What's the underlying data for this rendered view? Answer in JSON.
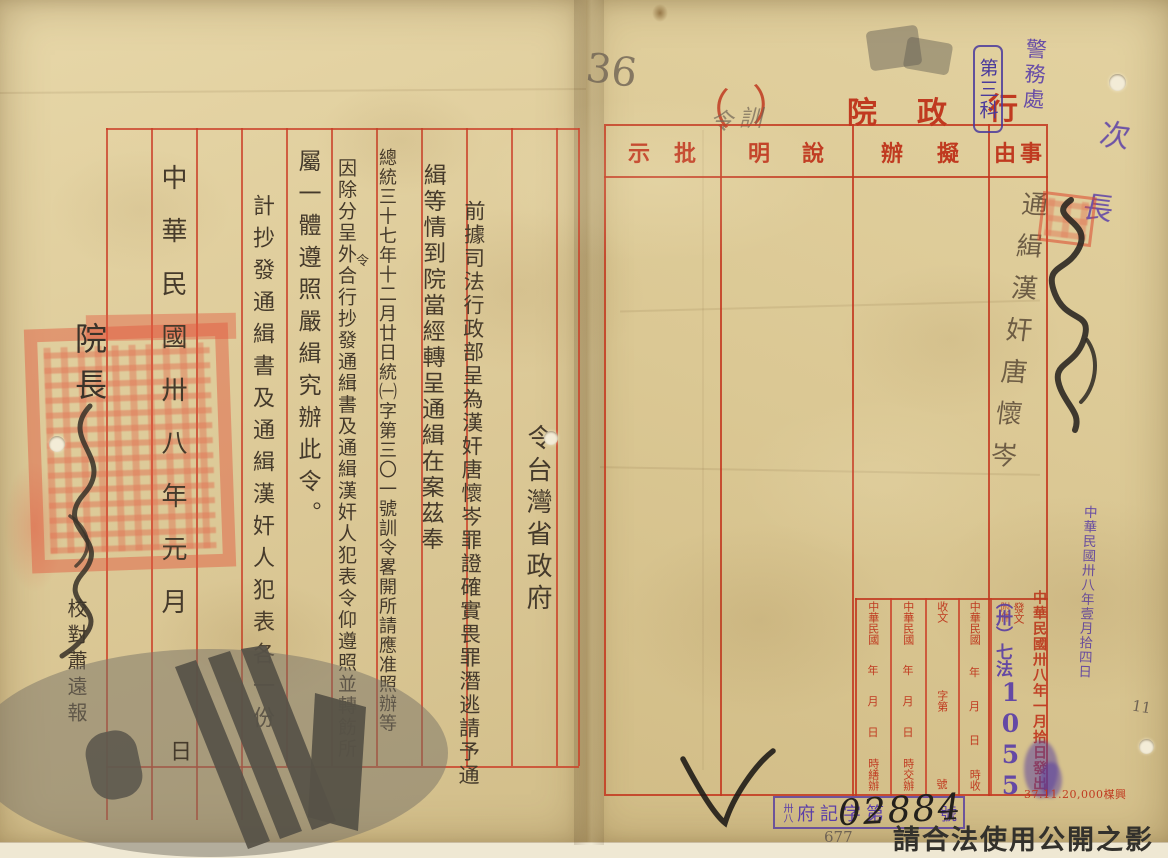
{
  "document": {
    "watermark_notice": "請合法使用公開之影像",
    "print_code": "37.11.20,000楳興",
    "folio_pencil": "36",
    "page_pencil": "11",
    "registry_pencil": "677",
    "paren_fill": "訓令",
    "purple_note": "次長"
  },
  "right_page": {
    "title": {
      "org": "行政院",
      "paren_open": "（",
      "paren_close": "）"
    },
    "stamps": {
      "police": "警務處",
      "section": "第三科",
      "received": "中華民國卅八年壹月拾四日",
      "dispatch": "中華民國卅八年一月拾日發出",
      "doc_class": "（卅）七法",
      "doc_number": "1055",
      "registry_prefix": "卅八",
      "registry_label": "府記字第",
      "registry_number": "02884",
      "registry_suffix": "號"
    },
    "form": {
      "headers": [
        "事由",
        "擬辦",
        "說明",
        "批示"
      ],
      "subject": "通緝漢奸唐懷岑",
      "subform": {
        "col_transcribe": {
          "era": "中華民國",
          "y": "年",
          "m": "月",
          "d": "日",
          "tail": "時繕辦"
        },
        "col_assign": {
          "era": "中華民國",
          "y": "年",
          "m": "月",
          "d": "日",
          "tail": "時交辦"
        },
        "col_receive_no": {
          "head": "收文",
          "mid": "字第",
          "tail": "號"
        },
        "col_receive": {
          "era": "中華民國",
          "y": "年",
          "m": "月",
          "d": "日",
          "tail": "時收"
        },
        "col_dispatch": {
          "label": "發文",
          "label2": "附件"
        }
      }
    }
  },
  "left_page": {
    "order_word": "令",
    "recipient": "台灣省政府",
    "body": [
      "前據司法行政部呈為漢奸唐懷岑罪證確實畏罪潛逃請予通",
      "緝等情到院當經轉呈通緝在案茲奉",
      "總統三十七年十二月廿日統㈠字第三〇一號訓令畧開所請應准照辦等",
      "因除分呈外合行抄發通緝書及通緝漢奸人犯表令仰遵照並轉飭所",
      "屬一體遵照嚴緝究辦此令。",
      "計抄發通緝書及通緝漢奸人犯表各一份"
    ],
    "insert_char": "令",
    "date_line": "中華民國卅八年元月",
    "date_day": "日",
    "signer_title": "院長",
    "proofread": "校對蕭遠報"
  }
}
